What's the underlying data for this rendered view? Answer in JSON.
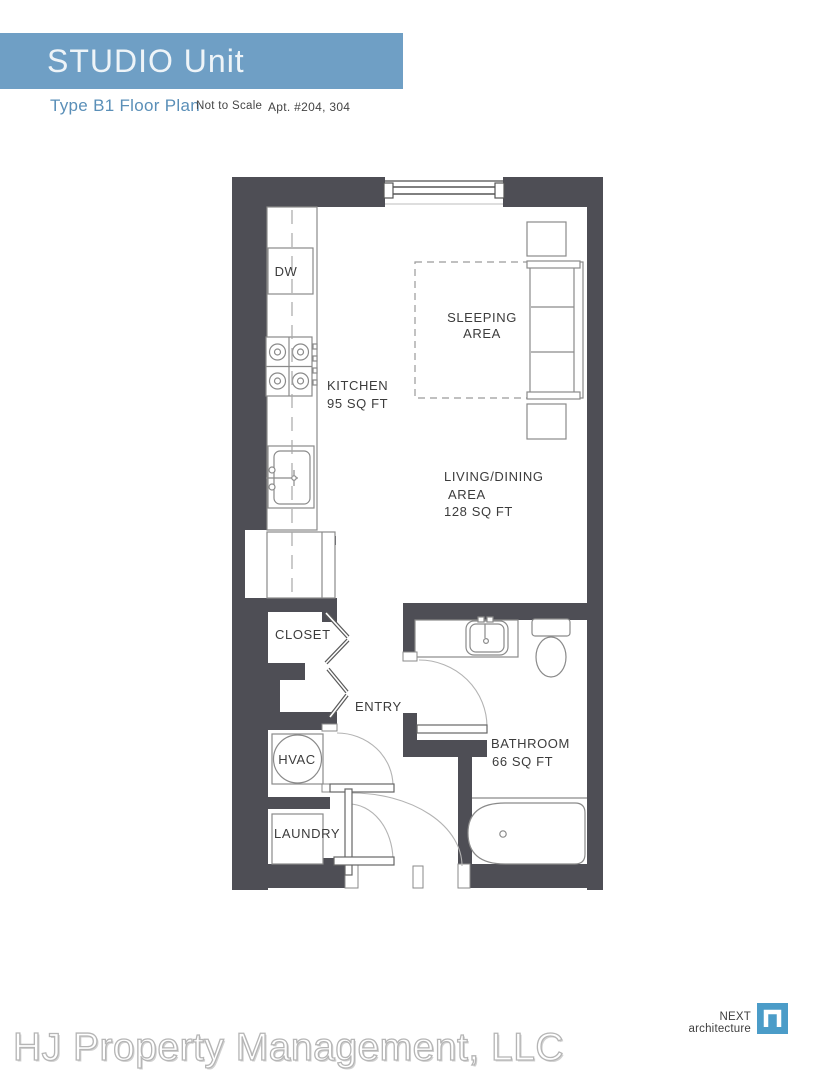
{
  "header": {
    "title": "STUDIO Unit",
    "plan_type": "Type B1 Floor Plan",
    "scale_note": "Not to Scale",
    "apartments": "Apt. #204, 304"
  },
  "floor_plan": {
    "rooms": {
      "dishwasher": {
        "name": "DW"
      },
      "kitchen": {
        "name": "KITCHEN",
        "area": "95 SQ FT"
      },
      "sleeping": {
        "line1": "SLEEPING",
        "line2": "AREA"
      },
      "living": {
        "line1": "LIVING/DINING",
        "line2": "AREA",
        "area": "128 SQ FT"
      },
      "closet": {
        "name": "CLOSET"
      },
      "entry": {
        "name": "ENTRY"
      },
      "hvac": {
        "name": "HVAC"
      },
      "laundry": {
        "name": "LAUNDRY"
      },
      "bathroom": {
        "name": "BATHROOM",
        "area": "66 SQ FT"
      }
    }
  },
  "footer": {
    "company": "HJ Property Management, LLC",
    "architect": "NEXT architecture"
  },
  "colors": {
    "header_bar": "#6f9fc5",
    "plan_type_text": "#5a8fb8",
    "wall": "#4e4e55",
    "logo_blue": "#4b9cc8"
  }
}
